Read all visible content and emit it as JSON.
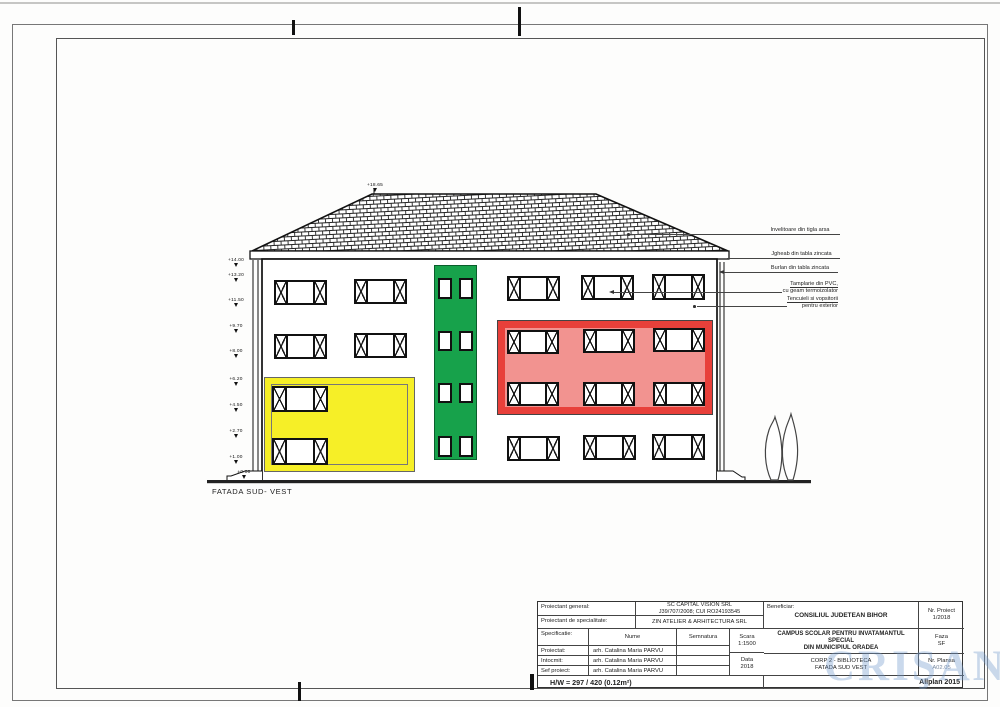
{
  "page": {
    "facade_label": "FATADA SUD- VEST",
    "paper_note": "H/W = 297 / 420 (0.12m²)",
    "watermark": "CRIŞANA"
  },
  "elevation": {
    "ridge_marker": "+18.65",
    "level_markers": [
      "+14.00",
      "+13.20",
      "+11.50",
      "+9.70",
      "+8.00",
      "+6.20",
      "+4.50",
      "+2.70",
      "+1.00",
      "±0.00"
    ],
    "annotations": {
      "roof": "Invelitoare din tigla arsa",
      "gutter": "Jgheab din tabla zincata",
      "downspout": "Burlan din tabla zincata",
      "joinery1": "Tamplarie din PVC,",
      "joinery2": "cu geam termoizolator",
      "plaster1": "Tencuieli si vopsitorii",
      "plaster2": "pentru exterior"
    },
    "colors": {
      "yellow": "#F6EF27",
      "green": "#17A24B",
      "red_border": "#E8403A",
      "red_fill": "#F29390"
    }
  },
  "title_block": {
    "proiectant_general_label": "Proiectant general:",
    "proiectant_general_value1": "SC CAPITAL VISION SRL",
    "proiectant_general_value2": "J39/707/2008; CUI RO24193545",
    "proiectant_specialitate_label": "Proiectant de specialitate:",
    "proiectant_specialitate_value": "ZIN ATELIER & ARHITECTURA SRL",
    "specificatie_label": "Specificatie:",
    "nume_label": "Nume",
    "semnatura_label": "Semnatura",
    "scara_label": "Scara",
    "scara_value": "1:1500",
    "data_label": "Data",
    "data_value": "2018",
    "rows": [
      {
        "label": "Proiectat:",
        "name": "arh. Catalina Maria PARVU"
      },
      {
        "label": "Intocmit:",
        "name": "arh. Catalina Maria PARVU"
      },
      {
        "label": "Sef proiect:",
        "name": "arh. Catalina Maria PARVU"
      }
    ],
    "beneficiar_label": "Beneficiar:",
    "beneficiar_value": "CONSILIUL JUDETEAN BIHOR",
    "nr_proiect_label": "Nr. Proiect",
    "nr_proiect_value": "1/2018",
    "proiect_title1": "CAMPUS SCOLAR PENTRU INVATAMANTUL SPECIAL",
    "proiect_title2": "DIN MUNICIPIUL ORADEA",
    "faza_label": "Faza",
    "faza_value": "SF",
    "plansa_title1": "CORP 2 - BIBLIOTECA",
    "plansa_title2": "FATADA SUD VEST",
    "nr_plansa_label": "Nr. Plansa",
    "nr_plansa_value": "A02.05",
    "software": "Allplan 2015"
  }
}
